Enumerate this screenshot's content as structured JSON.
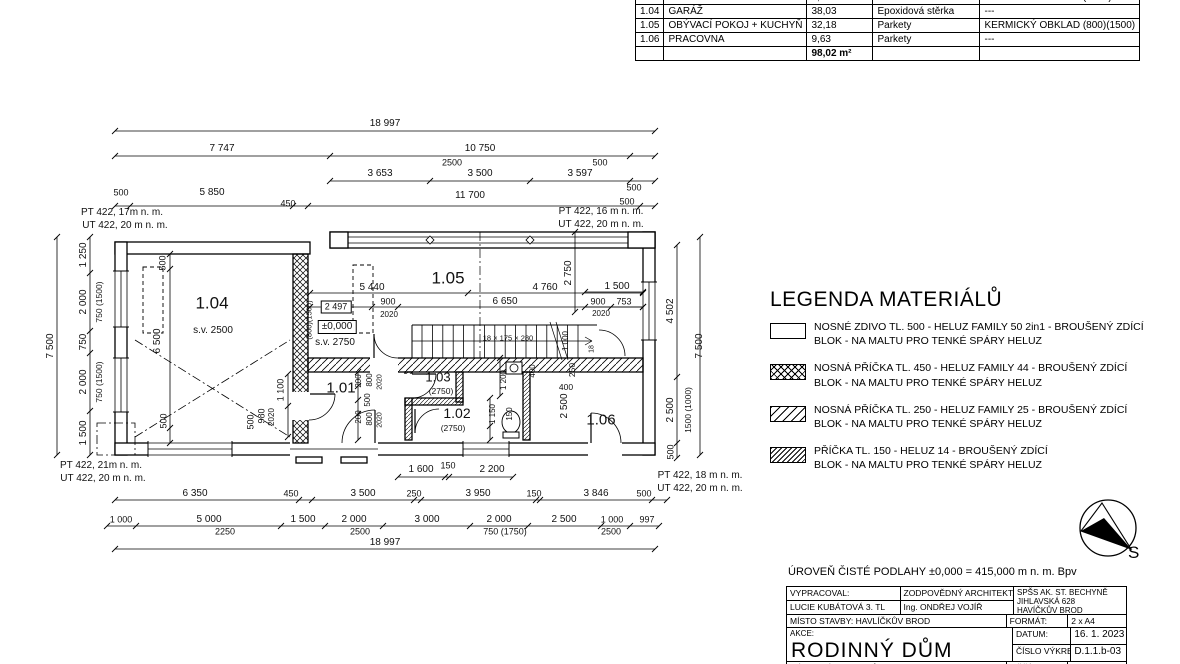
{
  "room_table": {
    "rows": [
      [
        "1.03",
        "WC",
        "1,92",
        "Keramická dlažba",
        "KERMICKÝ OBKLAD (2750)"
      ],
      [
        "1.04",
        "GARÁŽ",
        "38,03",
        "Epoxidová stěrka",
        "---"
      ],
      [
        "1.05",
        "OBÝVACÍ POKOJ + KUCHYŇ",
        "32,18",
        "Parkety",
        "KERMICKÝ OBKLAD (800)(1500)"
      ],
      [
        "1.06",
        "PRACOVNA",
        "9,63",
        "Parkety",
        "---"
      ]
    ],
    "total_area": "98,02 m²"
  },
  "legend": {
    "title": "LEGENDA MATERIÁLŮ",
    "items": [
      {
        "swatch": "solid",
        "line1": "NOSNÉ ZDIVO TL. 500 - HELUZ FAMILY 50 2in1 - BROUŠENÝ ZDÍCÍ",
        "line2": "BLOK - NA MALTU PRO TENKÉ SPÁRY HELUZ"
      },
      {
        "swatch": "crosshatch",
        "line1": "NOSNÁ PŘÍČKA TL. 450 - HELUZ FAMILY 44 - BROUŠENÝ ZDÍCÍ",
        "line2": "BLOK - NA MALTU PRO TENKÉ SPÁRY HELUZ"
      },
      {
        "swatch": "hatch",
        "line1": "NOSNÁ PŘÍČKA TL. 250 - HELUZ FAMILY 25 - BROUŠENÝ ZDÍCÍ",
        "line2": "BLOK - NA MALTU PRO TENKÉ SPÁRY HELUZ"
      },
      {
        "swatch": "hatch-fine",
        "line1": "PŘÍČKA TL. 150 - HELUZ 14 - BROUŠENÝ ZDÍCÍ",
        "line2": "BLOK - NA MALTU PRO TENKÉ SPÁRY HELUZ"
      }
    ]
  },
  "floor_note": "ÚROVEŇ ČISTÉ PODLAHY ±0,000 = 415,000 m n. m. Bpv",
  "title_block": {
    "vypracoval_label": "VYPRACOVAL:",
    "vypracoval": "LUCIE KUBÁTOVÁ 3. TL",
    "architekt_label": "ZODPOVĚDNÝ ARCHITEKT:",
    "architekt": "Ing. ONDŘEJ VOJÍŘ",
    "school_line1": "SPŠS AK. ST. BECHYNĚ",
    "school_line2": "JIHLAVSKÁ 628",
    "school_line3": "HAVÍČKŮV BROD",
    "misto": "MÍSTO STAVBY: HAVLÍČKŮV BROD",
    "akce_label": "AKCE:",
    "akce": "RODINNÝ DŮM",
    "format_label": "FORMÁT:",
    "format": "2 x A4",
    "datum_label": "DATUM:",
    "datum": "16. 1. 2023",
    "cislo_label": "ČÍSLO VÝKRESU:",
    "cislo": "D.1.1.b-03",
    "nazev": "NÁZEV VÝKRESU: PŮDORYS 1. NP",
    "meritko_label": "MĚŘÍTKO:",
    "meritko": "1:100"
  },
  "compass": {
    "label": "S"
  },
  "plan_labels": [
    {
      "t": "18 997",
      "x": 385,
      "y": 124
    },
    {
      "t": "7 747",
      "x": 222,
      "y": 149
    },
    {
      "t": "10 750",
      "x": 480,
      "y": 149
    },
    {
      "t": "2500",
      "x": 452,
      "y": 163,
      "fs": 9
    },
    {
      "t": "500",
      "x": 600,
      "y": 163,
      "fs": 9
    },
    {
      "t": "3 653",
      "x": 380,
      "y": 174
    },
    {
      "t": "3 500",
      "x": 480,
      "y": 174
    },
    {
      "t": "3 597",
      "x": 580,
      "y": 174
    },
    {
      "t": "500",
      "x": 634,
      "y": 188,
      "fs": 9
    },
    {
      "t": "500",
      "x": 121,
      "y": 193,
      "fs": 9
    },
    {
      "t": "5 850",
      "x": 212,
      "y": 193
    },
    {
      "t": "450",
      "x": 288,
      "y": 204,
      "fs": 9
    },
    {
      "t": "11 700",
      "x": 470,
      "y": 196
    },
    {
      "t": "500",
      "x": 627,
      "y": 202,
      "fs": 9
    },
    {
      "t": "PT 422, 17m n. m.",
      "x": 122,
      "y": 213
    },
    {
      "t": "UT 422, 20 m n. m.",
      "x": 125,
      "y": 226
    },
    {
      "t": "PT 422, 16 m n. m.",
      "x": 601,
      "y": 212
    },
    {
      "t": "UT 422, 20 m n. m.",
      "x": 601,
      "y": 225
    },
    {
      "t": "PT 422, 21m n. m.",
      "x": 101,
      "y": 466
    },
    {
      "t": "UT 422, 20 m n. m.",
      "x": 103,
      "y": 479
    },
    {
      "t": "PT 422, 18 m n. m.",
      "x": 700,
      "y": 476
    },
    {
      "t": "UT 422, 20 m n. m.",
      "x": 700,
      "y": 489
    },
    {
      "t": "7 500",
      "x": 51,
      "y": 346,
      "r": 1
    },
    {
      "t": "1 250",
      "x": 84,
      "y": 255,
      "r": 1
    },
    {
      "t": "2 000",
      "x": 84,
      "y": 302,
      "r": 1
    },
    {
      "t": "750 (1500)",
      "x": 99,
      "y": 302,
      "r": 1,
      "fs": 8.5
    },
    {
      "t": "750",
      "x": 84,
      "y": 342,
      "r": 1
    },
    {
      "t": "2 000",
      "x": 84,
      "y": 382,
      "r": 1
    },
    {
      "t": "750 (1500)",
      "x": 99,
      "y": 382,
      "r": 1,
      "fs": 8.5
    },
    {
      "t": "1 500",
      "x": 84,
      "y": 433,
      "r": 1
    },
    {
      "t": "4 502",
      "x": 671,
      "y": 311,
      "r": 1
    },
    {
      "t": "2 500",
      "x": 671,
      "y": 410,
      "r": 1
    },
    {
      "t": "1500 (1000)",
      "x": 688,
      "y": 410,
      "r": 1,
      "fs": 8.5
    },
    {
      "t": "500",
      "x": 671,
      "y": 452,
      "r": 1,
      "fs": 9
    },
    {
      "t": "7 500",
      "x": 700,
      "y": 346,
      "r": 1
    },
    {
      "t": "1.04",
      "x": 212,
      "y": 303,
      "fs": 17
    },
    {
      "t": "s.v. 2500",
      "x": 213,
      "y": 331,
      "fs": 10
    },
    {
      "t": "500",
      "x": 163,
      "y": 263,
      "r": 1,
      "fs": 9
    },
    {
      "t": "6 500",
      "x": 158,
      "y": 341,
      "r": 1
    },
    {
      "t": "500",
      "x": 164,
      "y": 421,
      "r": 1,
      "fs": 9
    },
    {
      "t": "1 100",
      "x": 281,
      "y": 390,
      "r": 1,
      "fs": 9
    },
    {
      "t": "980",
      "x": 262,
      "y": 416,
      "r": 1,
      "fs": 9
    },
    {
      "t": "2020",
      "x": 272,
      "y": 417,
      "r": 1,
      "fs": 8
    },
    {
      "t": "500",
      "x": 251,
      "y": 422,
      "r": 1,
      "fs": 9
    },
    {
      "t": "1.05",
      "x": 448,
      "y": 278,
      "fs": 17
    },
    {
      "t": "5 440",
      "x": 372,
      "y": 288
    },
    {
      "t": "2 497",
      "x": 336,
      "y": 307,
      "fs": 9,
      "box": 1
    },
    {
      "t": "900",
      "x": 388,
      "y": 302,
      "fs": 9
    },
    {
      "t": "2020",
      "x": 389,
      "y": 315,
      "fs": 8
    },
    {
      "t": "6 650",
      "x": 505,
      "y": 302
    },
    {
      "t": "4 760",
      "x": 545,
      "y": 288
    },
    {
      "t": "(800)(1500)",
      "x": 309,
      "y": 320,
      "r": 1,
      "fs": 7.5
    },
    {
      "t": "±0,000",
      "x": 337,
      "y": 327,
      "fs": 10,
      "box": 1
    },
    {
      "t": "s.v. 2750",
      "x": 335,
      "y": 343,
      "fs": 10
    },
    {
      "t": "18 × 175 × 280",
      "x": 508,
      "y": 338,
      "fs": 7.5
    },
    {
      "t": "1 000",
      "x": 566,
      "y": 341,
      "r": 1,
      "fs": 8
    },
    {
      "t": "18",
      "x": 592,
      "y": 349,
      "r": 1,
      "fs": 7
    },
    {
      "t": "2 750",
      "x": 569,
      "y": 273,
      "r": 1
    },
    {
      "t": "1 500",
      "x": 617,
      "y": 287
    },
    {
      "t": "900",
      "x": 598,
      "y": 302,
      "fs": 9
    },
    {
      "t": "753",
      "x": 624,
      "y": 302,
      "fs": 9
    },
    {
      "t": "2020",
      "x": 601,
      "y": 314,
      "fs": 8
    },
    {
      "t": "1.01",
      "x": 341,
      "y": 388,
      "fs": 15
    },
    {
      "t": "200",
      "x": 359,
      "y": 381,
      "r": 1,
      "fs": 8
    },
    {
      "t": "800",
      "x": 370,
      "y": 380,
      "r": 1,
      "fs": 8
    },
    {
      "t": "2020",
      "x": 380,
      "y": 382,
      "r": 1,
      "fs": 7
    },
    {
      "t": "500",
      "x": 368,
      "y": 400,
      "r": 1,
      "fs": 8
    },
    {
      "t": "200",
      "x": 359,
      "y": 417,
      "r": 1,
      "fs": 8
    },
    {
      "t": "800",
      "x": 370,
      "y": 419,
      "r": 1,
      "fs": 8
    },
    {
      "t": "2020",
      "x": 380,
      "y": 420,
      "r": 1,
      "fs": 7
    },
    {
      "t": "1.03",
      "x": 438,
      "y": 377,
      "fs": 13
    },
    {
      "t": "(2750)",
      "x": 441,
      "y": 391,
      "fs": 8.5
    },
    {
      "t": "1.02",
      "x": 457,
      "y": 413,
      "fs": 14
    },
    {
      "t": "(2750)",
      "x": 453,
      "y": 428,
      "fs": 8.5
    },
    {
      "t": "400",
      "x": 533,
      "y": 371,
      "r": 1,
      "fs": 8
    },
    {
      "t": "400",
      "x": 566,
      "y": 387,
      "fs": 8.5
    },
    {
      "t": "1 200",
      "x": 504,
      "y": 380,
      "r": 1,
      "fs": 8
    },
    {
      "t": "1 150",
      "x": 493,
      "y": 414,
      "r": 1,
      "fs": 8
    },
    {
      "t": "150",
      "x": 510,
      "y": 414,
      "r": 1,
      "fs": 8
    },
    {
      "t": "250",
      "x": 572,
      "y": 370,
      "r": 1,
      "fs": 8.5
    },
    {
      "t": "2 500",
      "x": 565,
      "y": 406,
      "r": 1
    },
    {
      "t": "1.06",
      "x": 601,
      "y": 420,
      "fs": 15
    },
    {
      "t": "1 600",
      "x": 421,
      "y": 470
    },
    {
      "t": "150",
      "x": 448,
      "y": 466,
      "fs": 9
    },
    {
      "t": "2 200",
      "x": 492,
      "y": 470
    },
    {
      "t": "6 350",
      "x": 195,
      "y": 494
    },
    {
      "t": "450",
      "x": 291,
      "y": 494,
      "fs": 9
    },
    {
      "t": "3 500",
      "x": 363,
      "y": 494
    },
    {
      "t": "250",
      "x": 414,
      "y": 494,
      "fs": 9
    },
    {
      "t": "3 950",
      "x": 478,
      "y": 494
    },
    {
      "t": "150",
      "x": 534,
      "y": 494,
      "fs": 9
    },
    {
      "t": "3 846",
      "x": 596,
      "y": 494
    },
    {
      "t": "500",
      "x": 644,
      "y": 494,
      "fs": 9
    },
    {
      "t": "1 000",
      "x": 121,
      "y": 520,
      "fs": 9
    },
    {
      "t": "5 000",
      "x": 209,
      "y": 520
    },
    {
      "t": "2250",
      "x": 225,
      "y": 532,
      "fs": 9
    },
    {
      "t": "1 500",
      "x": 303,
      "y": 520
    },
    {
      "t": "2 000",
      "x": 354,
      "y": 520
    },
    {
      "t": "2500",
      "x": 360,
      "y": 532,
      "fs": 9
    },
    {
      "t": "3 000",
      "x": 427,
      "y": 520
    },
    {
      "t": "2 000",
      "x": 499,
      "y": 520
    },
    {
      "t": "750 (1750)",
      "x": 505,
      "y": 532,
      "fs": 9
    },
    {
      "t": "2 500",
      "x": 564,
      "y": 520
    },
    {
      "t": "1 000",
      "x": 612,
      "y": 520,
      "fs": 9
    },
    {
      "t": "2500",
      "x": 611,
      "y": 532,
      "fs": 9
    },
    {
      "t": "997",
      "x": 647,
      "y": 520,
      "fs": 9
    },
    {
      "t": "18 997",
      "x": 385,
      "y": 543
    }
  ]
}
